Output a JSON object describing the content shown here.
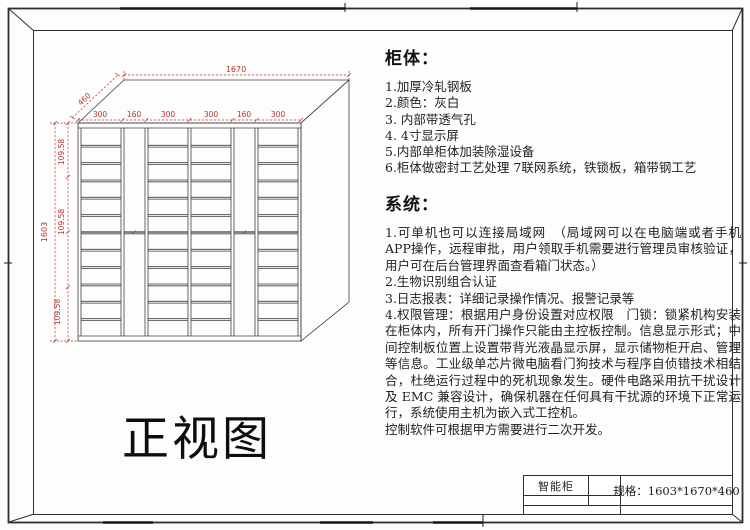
{
  "sheet": {
    "view_title": "正视图",
    "title_block": {
      "product_name": "智能柜",
      "spec_text": "规格：1603*1670*460"
    }
  },
  "specs": {
    "cabinet": {
      "heading": "柜体：",
      "items": [
        "1.加厚冷轧钢板",
        "2.颜色：灰白",
        "3.  内部带透气孔",
        "4.  4寸显示屏",
        "5.内部单柜体加装除湿设备",
        "6.柜体做密封工艺处理 7联网系统，铁锁板，箱带钢工艺"
      ]
    },
    "system": {
      "heading": "系统：",
      "paragraphs": [
        "1.可单机也可以连接局域网　（局域网可以在电脑端或者手机APP操作，远程审批，用户领取手机需要进行管理员审核验证，用户可在后台管理界面查看箱门状态。）",
        "2.生物识别组合认证",
        "3.日志报表：详细记录操作情况、报警记录等",
        "4.权限管理：根据用户身份设置对应权限　门锁：锁紧机构安装在柜体内，所有开门操作只能由主控板控制。信息显示形式；中间控制板位置上设置带背光液晶显示屏，显示储物柜开启、管理等信息。工业级单芯片微电脑看门狗技术与程序自侦错技术相结合，杜绝运行过程中的死机现象发生。硬件电路采用抗干扰设计及 EMC 兼容设计，确保机器在任何具有干扰源的环境下正常运行，系统使用主机为嵌入式工控机。",
        "控制软件可根据甲方需要进行二次开发。"
      ]
    }
  },
  "drawing": {
    "dims": {
      "total_width": "1670",
      "depth": "460",
      "total_height": "1603",
      "column_widths": [
        "300",
        "160",
        "300",
        "300",
        "160",
        "300"
      ],
      "height_segments": [
        "109.58",
        "109.58",
        "109.58"
      ]
    },
    "colors": {
      "dimension_red": "#b5342e",
      "drawing_line": "#3f3f3f",
      "frame_line": "#2f2f2f"
    }
  }
}
